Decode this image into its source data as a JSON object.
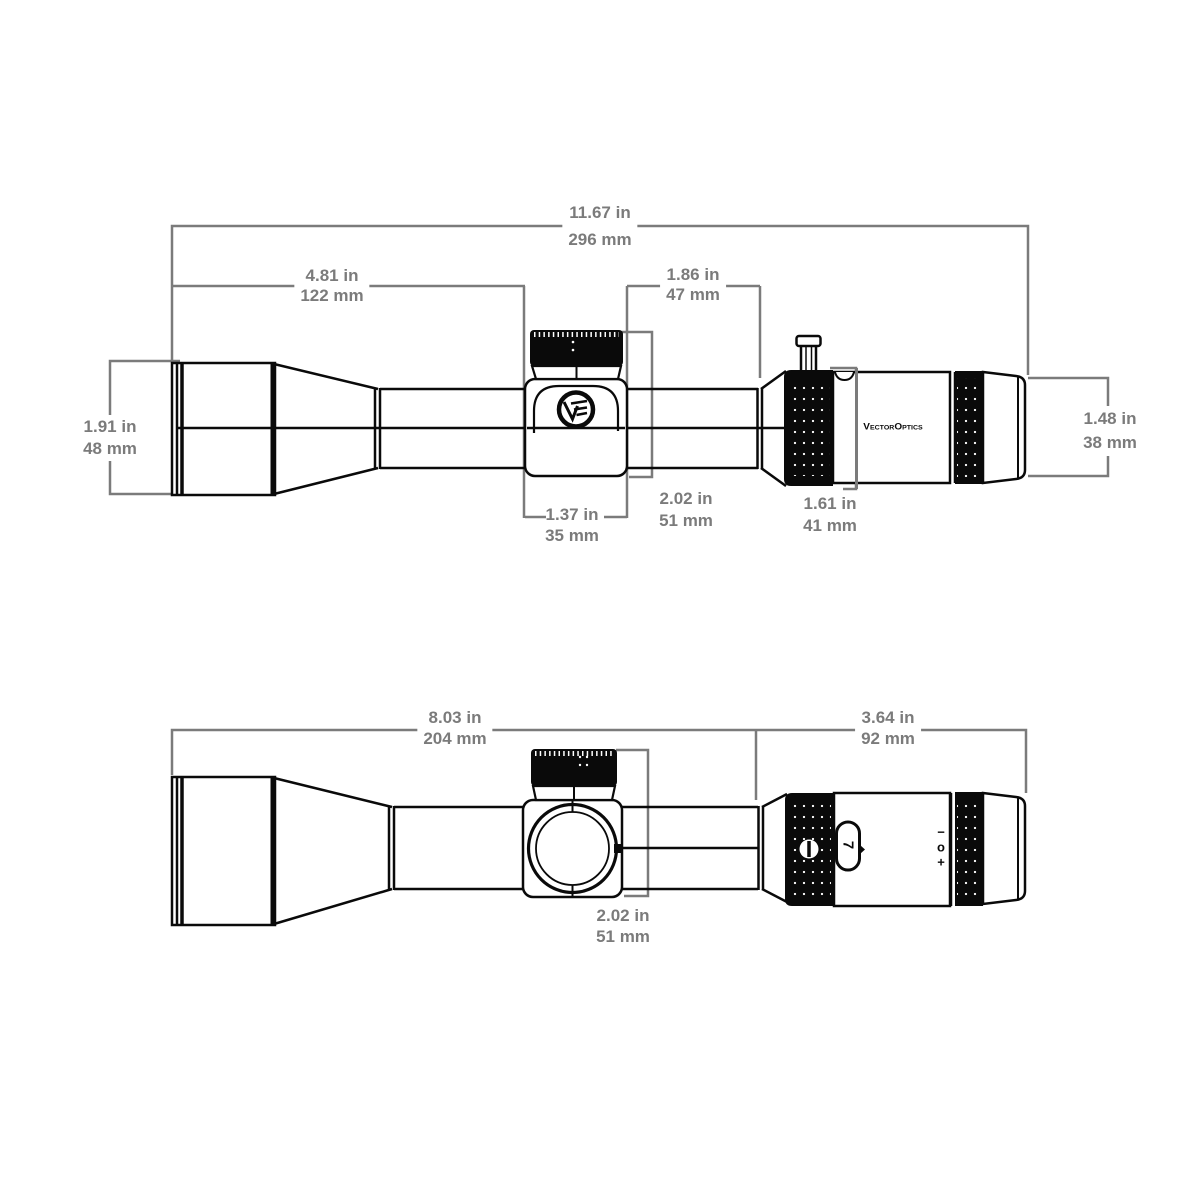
{
  "diagram": {
    "type": "riflescope dimensional drawing, side view and top view",
    "line_color": "#0a0a0a",
    "dimension_color": "#7b7b7b"
  },
  "brand": {
    "logotype": "VectorOptics",
    "roundel_icon": "VE-monogram"
  },
  "markings": {
    "zoom_number": "7",
    "diopter_minus": "−",
    "diopter_zero": "o",
    "diopter_plus": "+"
  },
  "dims": {
    "overall": {
      "in": "11.67 in",
      "mm": "296 mm"
    },
    "objective_section": {
      "in": "4.81 in",
      "mm": "122 mm"
    },
    "saddle_to_ring": {
      "in": "1.86 in",
      "mm": "47 mm"
    },
    "objective_od": {
      "in": "1.91 in",
      "mm": "48 mm"
    },
    "eyepiece_od": {
      "in": "1.48 in",
      "mm": "38 mm"
    },
    "saddle_length": {
      "in": "1.37 in",
      "mm": "35 mm"
    },
    "turret_height": {
      "in": "2.02 in",
      "mm": "51 mm"
    },
    "power_ring_od": {
      "in": "1.61 in",
      "mm": "41 mm"
    },
    "front_section": {
      "in": "8.03 in",
      "mm": "204 mm"
    },
    "ocular_section": {
      "in": "3.64 in",
      "mm": "92 mm"
    },
    "turret_width": {
      "in": "2.02 in",
      "mm": "51 mm"
    }
  }
}
